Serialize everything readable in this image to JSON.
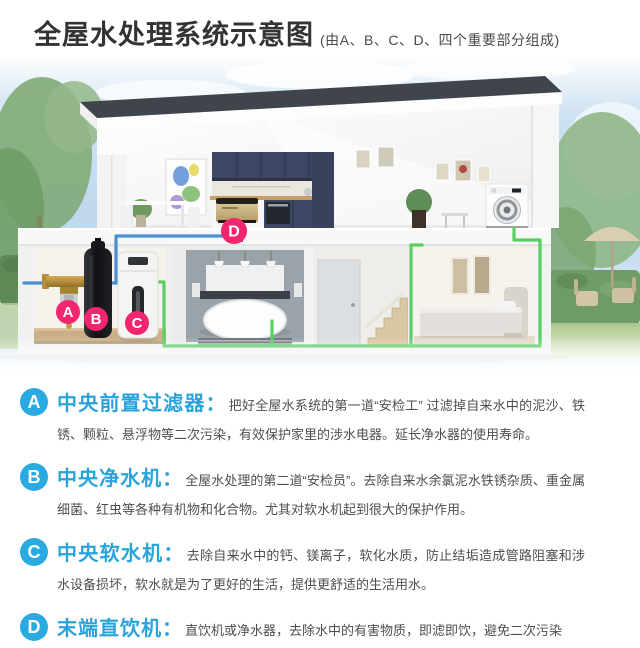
{
  "header": {
    "title": "全屋水处理系统示意图",
    "subtitle": "(由A、B、C、D、四个重要部分组成)"
  },
  "illustration": {
    "labels": {
      "a": "A",
      "b": "B",
      "c": "C",
      "d": "D"
    }
  },
  "sections": [
    {
      "letter": "A",
      "heading": "中央前置过滤器：",
      "text": "把好全屋水系统的第一道“安检工” 过滤掉自来水中的泥沙、铁锈、颗粒、悬浮物等二次污染，有效保护家里的涉水电器。延长净水器的使用寿命。"
    },
    {
      "letter": "B",
      "heading": "中央净水机：",
      "text": "全屋水处理的第二道“安检员”。去除自来水余氯泥水铁锈杂质、重金属细菌、红虫等各种有机物和化合物。尤其对软水机起到很大的保护作用。"
    },
    {
      "letter": "C",
      "heading": "中央软水机：",
      "text": "去除自来水中的钙、镁离子，软化水质，防止结垢造成管路阻塞和涉水设备损坏，软水就是为了更好的生活，提供更舒适的生活用水。"
    },
    {
      "letter": "D",
      "heading": "末端直饮机：",
      "text": "直饮机或净水器，去除水中的有害物质，即滤即饮，避免二次污染"
    }
  ],
  "colors": {
    "accent_blue": "#29abe2",
    "heading_blue": "#2aa3dc",
    "label_pink": "#f1266f",
    "pipe_blue": "#4a8fd0",
    "pipe_green": "#57cf63",
    "roof_dark": "#3f454b",
    "cabinet_navy": "#3d4763",
    "title_text": "#333333",
    "body_text": "#4e4e4e"
  }
}
